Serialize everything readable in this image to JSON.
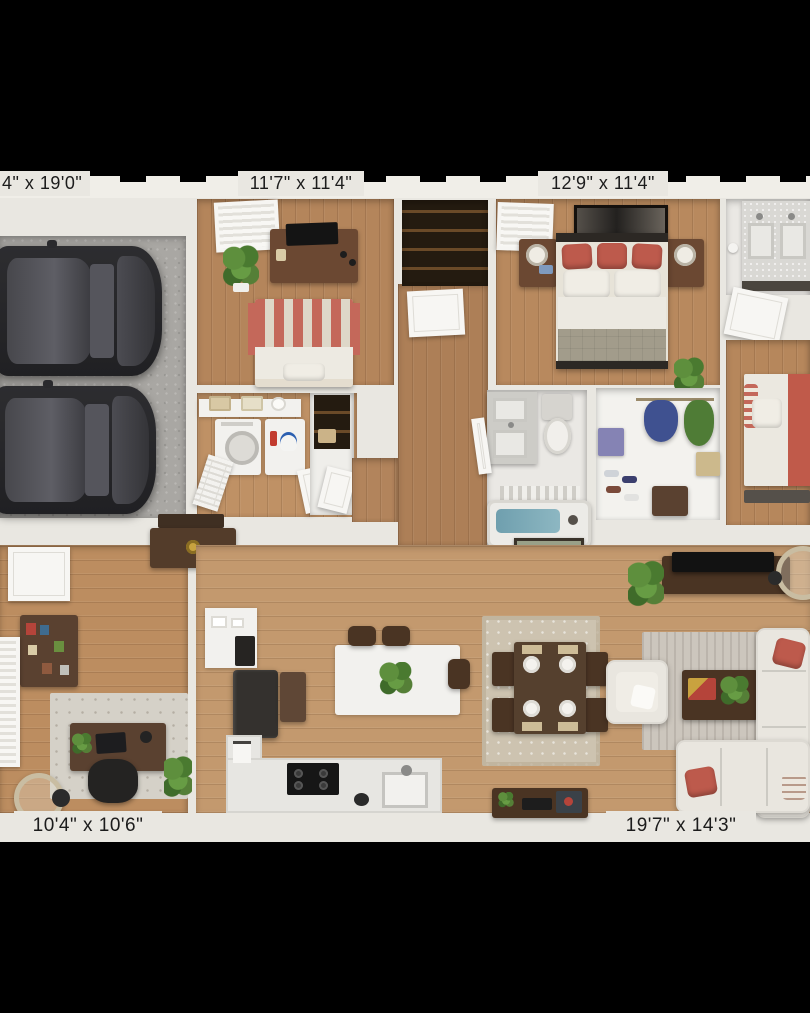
{
  "scene": {
    "type": "3D floor plan render, top-down view, letterboxed on black",
    "background_color": "#000000",
    "plan_background": "#e9e7e1"
  },
  "dimension_labels": {
    "garage": "4\" x 19'0\"",
    "bedroom_2": "11'7\" x 11'4\"",
    "master_bedroom": "12'9\" x 11'4\"",
    "office": "10'4\" x 10'6\"",
    "living_room": "19'7\" x 14'3\""
  },
  "rooms": [
    {
      "name": "garage",
      "label": "4\" x 19'0\"",
      "features": [
        "two dark sedans",
        "concrete floor"
      ]
    },
    {
      "name": "bedroom-2",
      "label": "11'7\" x 11'4\"",
      "features": [
        "bed with red striped blanket",
        "dresser with tv",
        "window",
        "potted plant"
      ]
    },
    {
      "name": "master-bedroom",
      "label": "12'9\" x 11'4\"",
      "features": [
        "bed with red pillows",
        "two nightstands with lamps",
        "wall art",
        "window",
        "plant"
      ]
    },
    {
      "name": "laundry-room",
      "features": [
        "front-load washer",
        "utility cabinet",
        "shelf with baskets",
        "louvered door"
      ]
    },
    {
      "name": "hall-closet",
      "features": [
        "dark shelving"
      ]
    },
    {
      "name": "bathroom-main",
      "features": [
        "vanity",
        "toilet",
        "bathtub with water"
      ]
    },
    {
      "name": "walk-in-closet",
      "features": [
        "hanging clothes",
        "shoe shelves",
        "storage boxes"
      ]
    },
    {
      "name": "bathroom-double-vanity",
      "features": [
        "double sink vanity",
        "door"
      ]
    },
    {
      "name": "bedroom-3",
      "features": [
        "bed with coral throw",
        "striped pillow"
      ]
    },
    {
      "name": "office",
      "label": "10'4\" x 10'6\"",
      "features": [
        "desk",
        "office chair",
        "bookcase",
        "area rug",
        "floor lamp",
        "window",
        "plants"
      ]
    },
    {
      "name": "kitchen",
      "features": [
        "l-shaped counter",
        "island with stools",
        "refrigerator",
        "cooktop",
        "sink",
        "pantry shelving"
      ]
    },
    {
      "name": "dining-area",
      "features": [
        "table with four place settings",
        "four chairs",
        "area rug"
      ]
    },
    {
      "name": "living-room",
      "label": "19'7\" x 14'3\"",
      "features": [
        "sectional sofa with red pillows",
        "armchair",
        "coffee table",
        "tv console",
        "floor lamp",
        "area rug",
        "media bench",
        "entry console",
        "wall art"
      ]
    }
  ],
  "colors": {
    "wood_floor": "#b4855b",
    "wood_floor_living": "#c3996e",
    "concrete": "#a9a7a3",
    "wall": "#e9e7e1",
    "dark_wood_furniture": "#5a4130",
    "sofa_cream": "#e9e6df",
    "accent_red": "#bd5a4c",
    "stripe_red": "#c4685a",
    "comforter_olive": "#a29c8b",
    "tub_water": "#74a2b0",
    "plant_green": "#5e8f3d",
    "label_text": "#1c1c1c"
  }
}
